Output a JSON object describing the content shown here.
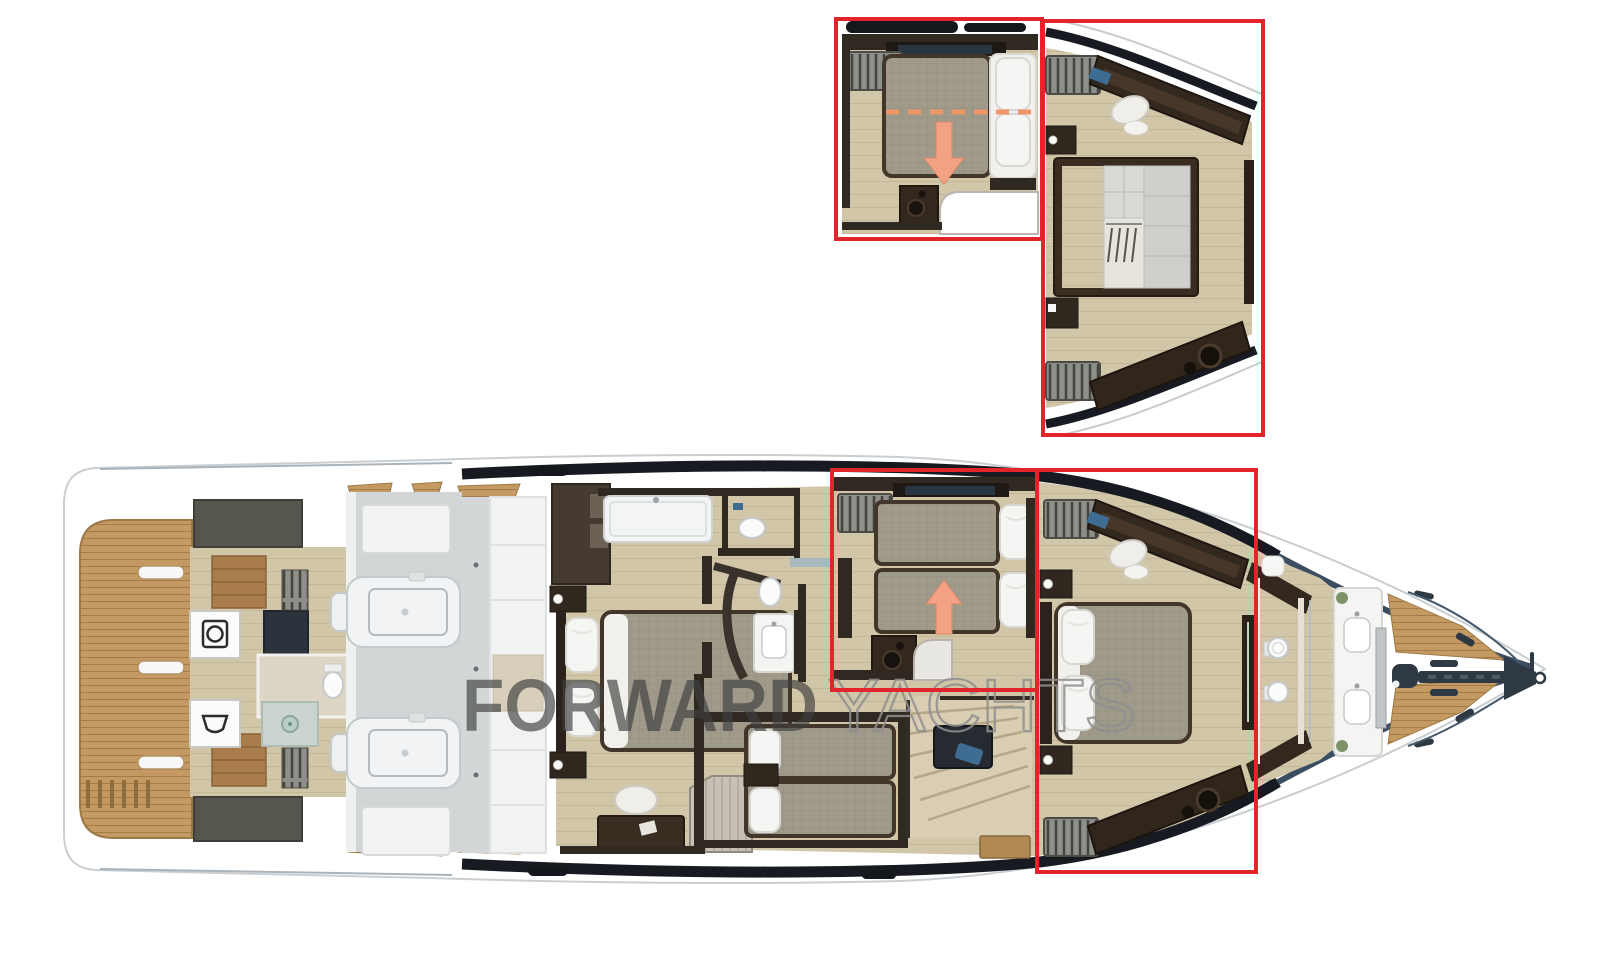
{
  "figure": {
    "type": "yacht-floor-plan-rendering"
  },
  "watermark": {
    "primary": "FORWARD",
    "secondary": "YACHTS"
  },
  "highlights": {
    "main_twin_cabin_box": "twin-guest-cabin",
    "main_master_cabin_box": "forward-master-cabin",
    "inset_left": "twin-cabin-sliding-berths-option",
    "inset_right": "master-cabin-walk-in-wardrobe-option"
  },
  "icons": {
    "arrow_up": "arrow-up-icon",
    "arrow_down": "arrow-down-icon",
    "washer": "washing-machine-icon",
    "sink": "laundry-sink-icon",
    "windlass": "anchor-windlass-icon"
  },
  "colors": {
    "highlight_red": "#e2252b",
    "arrow_salmon": "#f3a284",
    "arrow_edge": "#d98a66",
    "dash_orange": "#ef9668",
    "teak": "#c59a62",
    "teak_line": "#a37c47",
    "floor": "#d2c6a8",
    "floor_line": "#bfb294",
    "dark_wood": "#33281e",
    "wall_dark": "#2f2922",
    "navy_glazing": "#171b21",
    "sheer_blue": "#3a4d61",
    "gray_deck": "#d2d5d5",
    "mattress": "#a09a8b",
    "mattress_border": "#42362a",
    "pillow": "#f5f5f3",
    "bench_gray": "#8f8f89",
    "bench_slat": "#44443f",
    "watermark_dark": "#3f3f3f",
    "watermark_light": "#8f8f8f",
    "marble": "#c9d4ce",
    "plant_green": "#7d9468",
    "screen_blue": "#3f6c92"
  }
}
